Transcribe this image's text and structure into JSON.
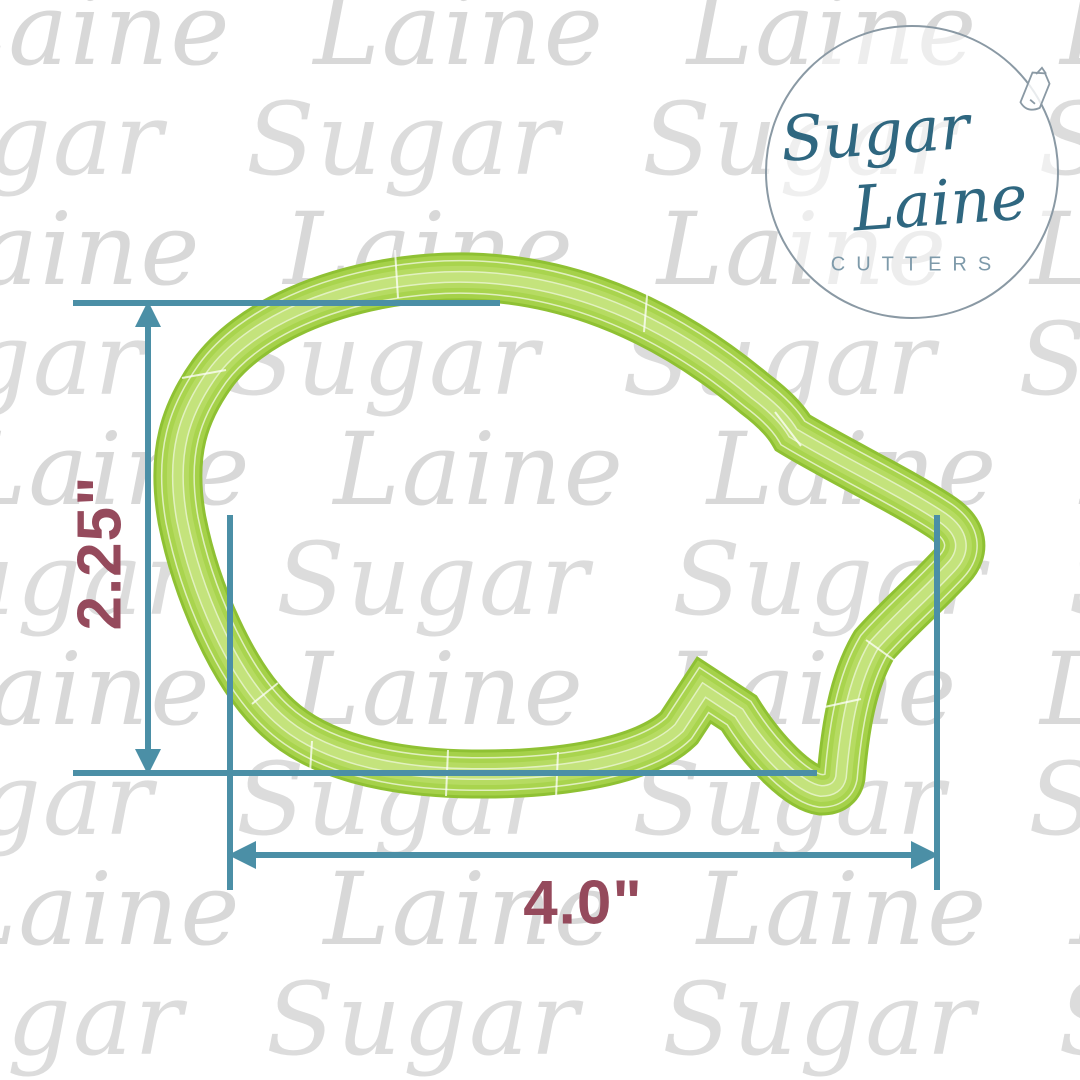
{
  "brand": {
    "word1": "Sugar",
    "word2": "Laine",
    "tagline": "CUTTERS"
  },
  "dimensions": {
    "height": "2.25\"",
    "width": "4.0\""
  },
  "watermark": {
    "rows": [
      {
        "text": "Laine Laine Laine Laine Laine",
        "x": -60,
        "y": -25
      },
      {
        "text": "Sugar Sugar Sugar Sugar Sugar",
        "x": -150,
        "y": 85
      },
      {
        "text": "Laine Laine Laine Laine Laine",
        "x": -90,
        "y": 195
      },
      {
        "text": "Sugar Sugar Sugar Sugar Sugar",
        "x": -170,
        "y": 305
      },
      {
        "text": "Laine Laine Laine Laine Laine",
        "x": -40,
        "y": 415
      },
      {
        "text": "Sugar Sugar Sugar Sugar Sugar",
        "x": -120,
        "y": 525
      },
      {
        "text": "Laine Laine Laine Laine Laine",
        "x": -80,
        "y": 635
      },
      {
        "text": "Sugar Sugar Sugar Sugar Sugar",
        "x": -160,
        "y": 745
      },
      {
        "text": "Laine Laine Laine Laine Laine",
        "x": -50,
        "y": 855
      },
      {
        "text": "Sugar Sugar Sugar Sugar Sugar",
        "x": -130,
        "y": 965
      }
    ]
  },
  "colors": {
    "teal": "#4b8fa6",
    "maroon": "#954a5c",
    "green_base": "#a5d149",
    "green_edge": "#8fc133",
    "green_light": "#c4e37c",
    "watermark_gray": "#d8d8d8",
    "logo_navy": "#2f6780",
    "logo_muted": "#7e9aaa",
    "logo_ring": "#8a99a4"
  }
}
